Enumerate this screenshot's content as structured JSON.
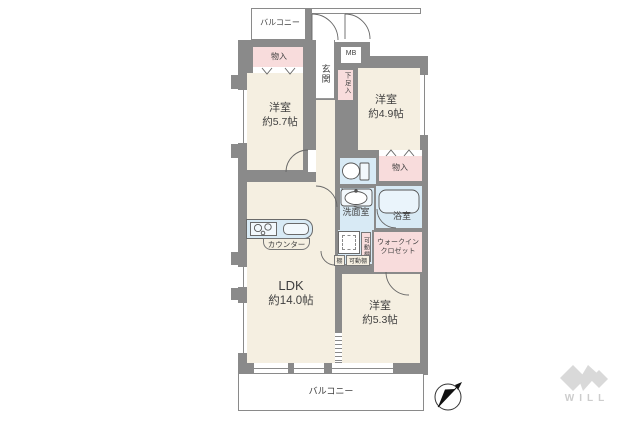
{
  "plan_title": "floor-plan",
  "colors": {
    "wall": "#8a8a8a",
    "room_fill": "#f5efe1",
    "wet_area_fill": "#d8eaf5",
    "closet_fill": "#f8dcdc",
    "logo_gray": "#d9d9d9"
  },
  "labels": {
    "balcony_top": "バルコニー",
    "storage_top": "物入",
    "entrance": "玄関",
    "meter_box": "MB",
    "shoe_storage": "下足入",
    "bedroom1": {
      "name": "洋室",
      "size": "約5.7帖"
    },
    "bedroom2": {
      "name": "洋室",
      "size": "約4.9帖"
    },
    "storage_mid": "物入",
    "washroom": "洗面室",
    "bathroom": "浴室",
    "wic": {
      "line1": "ウォークイン",
      "line2": "クロゼット"
    },
    "shelf": "棚",
    "movable_shelf": "可動棚",
    "movable_shelf_vertical": "可動棚",
    "counter": "カウンター",
    "ldk": {
      "name": "LDK",
      "size": "約14.0帖"
    },
    "bedroom3": {
      "name": "洋室",
      "size": "約5.3帖"
    },
    "balcony_bottom": "バルコニー",
    "brand": "WILL"
  }
}
